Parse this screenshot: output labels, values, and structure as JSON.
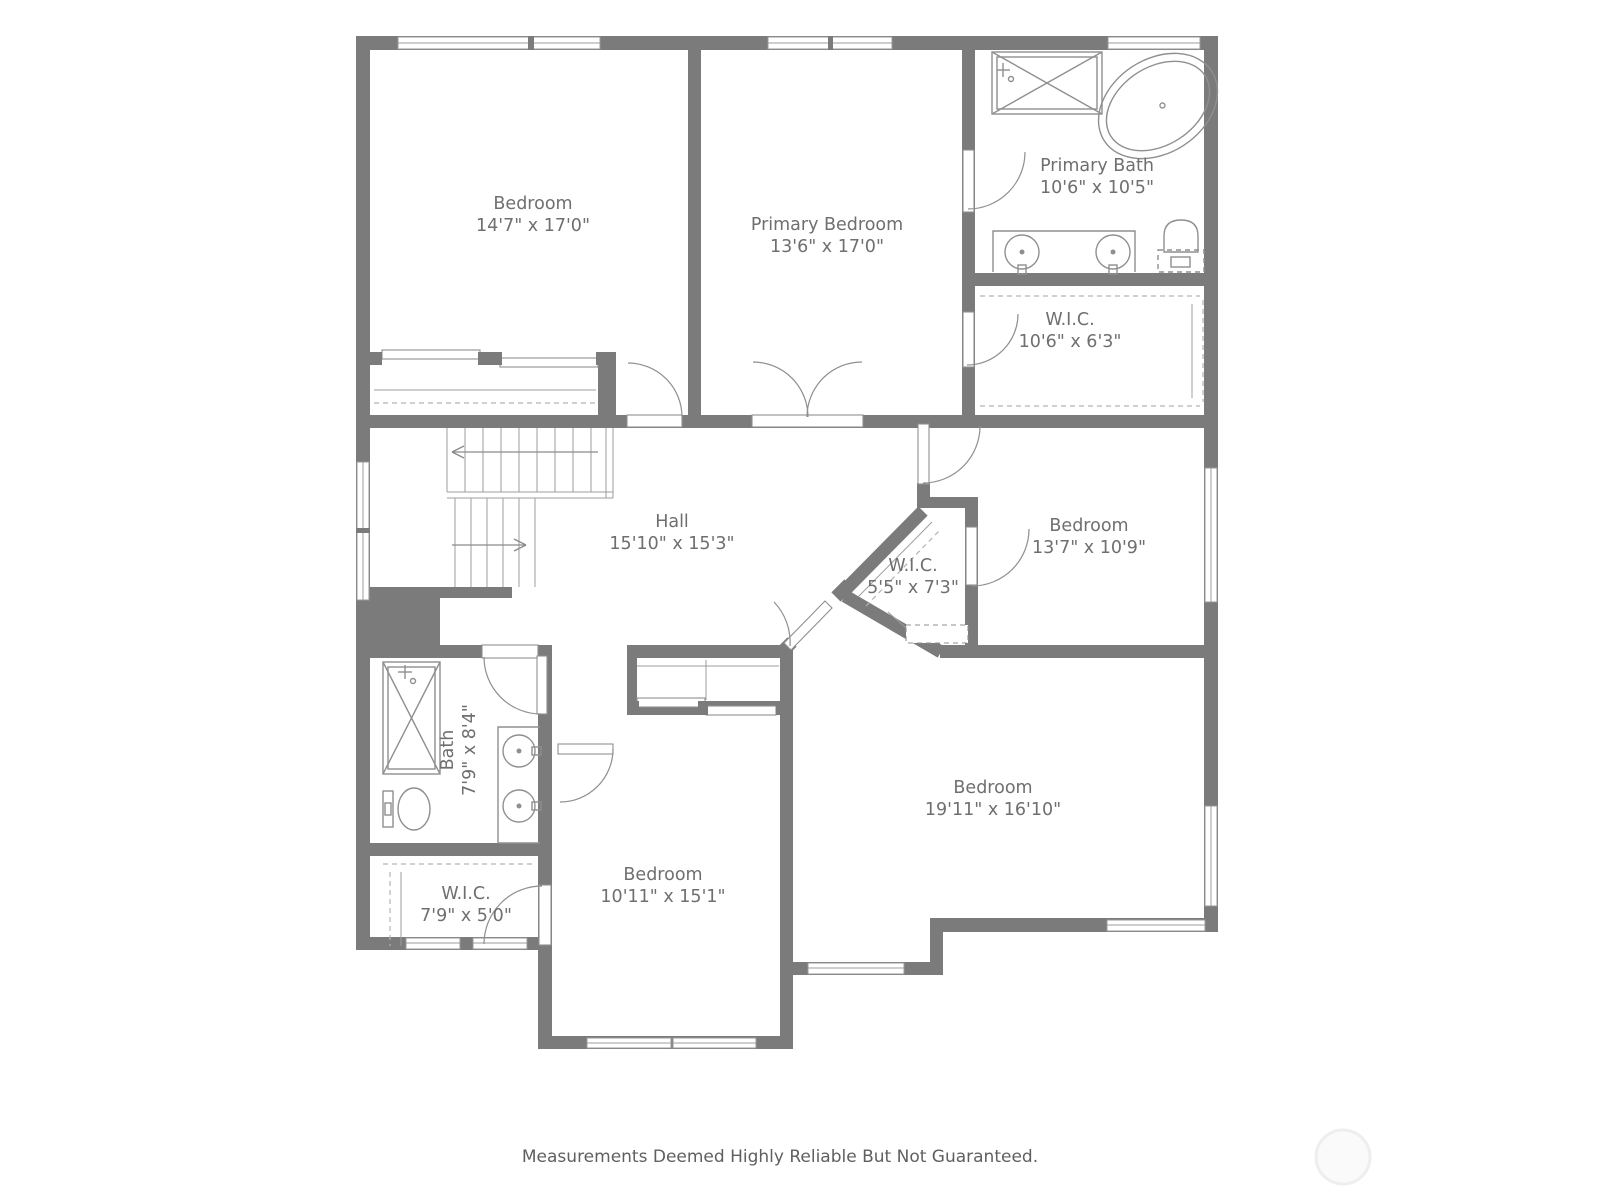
{
  "rooms": {
    "bedroom_tl": {
      "name": "Bedroom",
      "dims": "14'7\" x 17'0\""
    },
    "primary_bedroom": {
      "name": "Primary Bedroom",
      "dims": "13'6\" x 17'0\""
    },
    "primary_bath": {
      "name": "Primary Bath",
      "dims": "10'6\" x 10'5\""
    },
    "wic_primary": {
      "name": "W.I.C.",
      "dims": "10'6\" x 6'3\""
    },
    "hall": {
      "name": "Hall",
      "dims": "15'10\" x 15'3\""
    },
    "bedroom_right": {
      "name": "Bedroom",
      "dims": "13'7\" x 10'9\""
    },
    "wic_small": {
      "name": "W.I.C.",
      "dims": "5'5\" x 7'3\""
    },
    "bath": {
      "name": "Bath",
      "dims": "7'9\" x 8'4\""
    },
    "wic_lower": {
      "name": "W.I.C.",
      "dims": "7'9\" x 5'0\""
    },
    "bedroom_bottom": {
      "name": "Bedroom",
      "dims": "10'11\" x 15'1\""
    },
    "bedroom_large": {
      "name": "Bedroom",
      "dims": "19'11\" x 16'10\""
    }
  },
  "footer": {
    "disclaimer": "Measurements Deemed Highly Reliable But Not Guaranteed."
  },
  "colors": {
    "wall": "#7b7b7b",
    "fixture": "#8f8f8f",
    "label": "#6f6f6f"
  }
}
